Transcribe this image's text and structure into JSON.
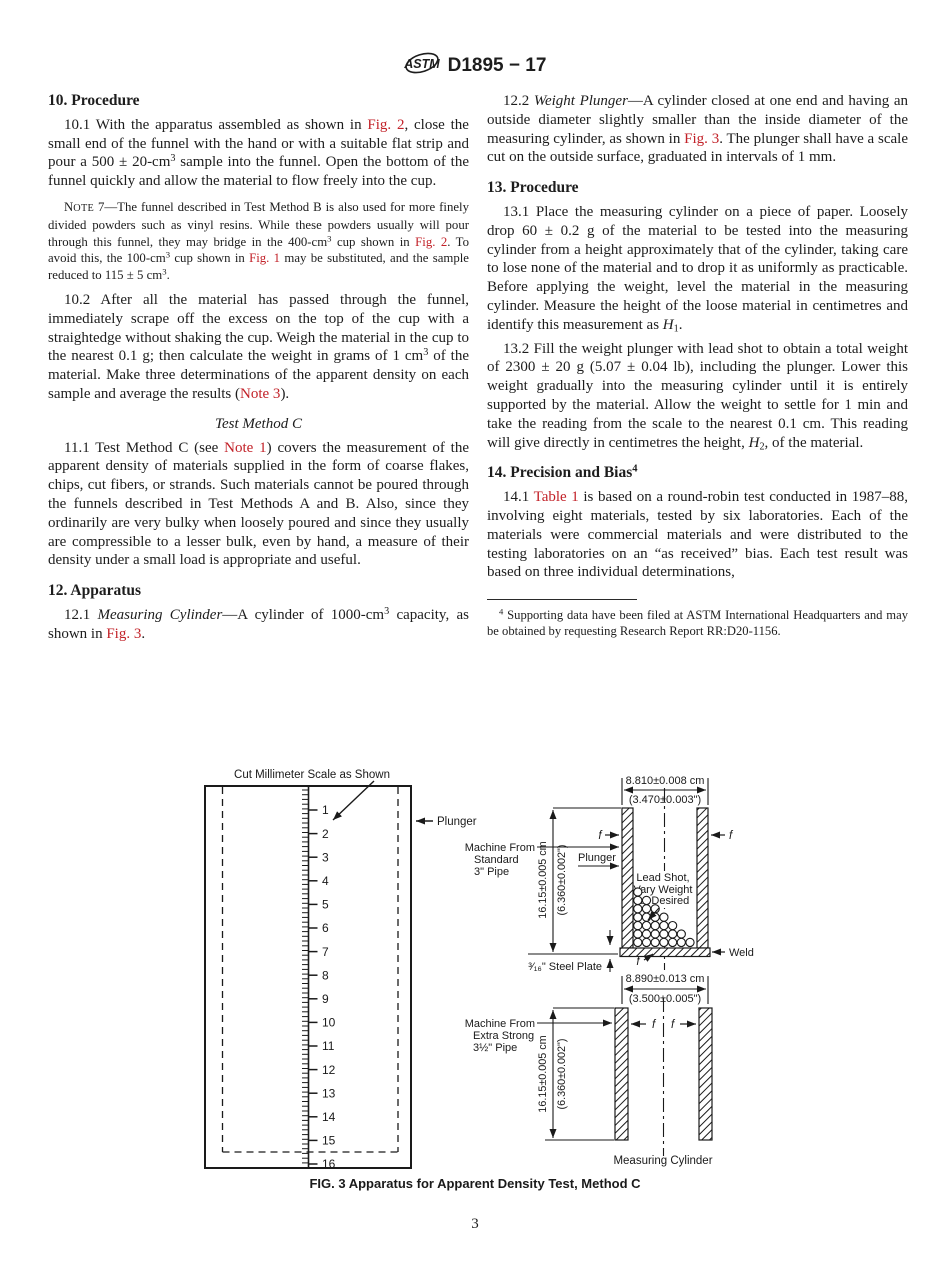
{
  "header": {
    "logo_text": "ASTM",
    "code": "D1895 − 17"
  },
  "page_number": "3",
  "left": {
    "h10": "10.  Procedure",
    "p10_1": [
      {
        "t": "10.1  With the apparatus assembled as shown in "
      },
      {
        "t": "Fig. 2",
        "c": "ref",
        "n": "ref-fig-2"
      },
      {
        "t": ", close the small end of the funnel with the hand or with a suitable flat strip and pour a 500 ± 20-cm"
      },
      {
        "t": "3",
        "c": "sup"
      },
      {
        "t": " sample into the funnel. Open the bottom of the funnel quickly and allow the material to flow freely into the cup."
      }
    ],
    "note7": [
      {
        "t": "N"
      },
      {
        "t": "OTE",
        "c": "sc"
      },
      {
        "t": " 7—The funnel described in Test Method B is also used for more finely divided powders such as vinyl resins. While these powders usually will pour through this funnel, they may bridge in the 400-cm"
      },
      {
        "t": "3",
        "c": "sup"
      },
      {
        "t": " cup shown in "
      },
      {
        "t": "Fig. 2",
        "c": "ref",
        "n": "ref-fig-2"
      },
      {
        "t": ". To avoid this, the 100-cm"
      },
      {
        "t": "3",
        "c": "sup"
      },
      {
        "t": " cup shown in "
      },
      {
        "t": "Fig. 1",
        "c": "ref",
        "n": "ref-fig-1"
      },
      {
        "t": " may be substituted, and the sample reduced to 115 ± 5 cm"
      },
      {
        "t": "3",
        "c": "sup"
      },
      {
        "t": "."
      }
    ],
    "p10_2": [
      {
        "t": "10.2  After all the material has passed through the funnel, immediately scrape off the excess on the top of the cup with a straightedge without shaking the cup. Weigh the material in the cup to the nearest 0.1 g; then calculate the weight in grams of 1 cm"
      },
      {
        "t": "3",
        "c": "sup"
      },
      {
        "t": " of the material. Make three determinations of the apparent density on each sample and average the results ("
      },
      {
        "t": "Note 3",
        "c": "ref",
        "n": "ref-note-3"
      },
      {
        "t": ")."
      }
    ],
    "h11": "Test Method C",
    "p11_1": [
      {
        "t": "11.1  Test Method C (see "
      },
      {
        "t": "Note 1",
        "c": "ref",
        "n": "ref-note-1"
      },
      {
        "t": ") covers the measurement of the apparent density of materials supplied in the form of coarse flakes, chips, cut fibers, or strands. Such materials cannot be poured through the funnels described in Test Methods A and B. Also, since they ordinarily are very bulky when loosely poured and since they usually are compressible to a lesser bulk, even by hand, a measure of their density under a small load is appropriate and useful."
      }
    ],
    "h12": "12.  Apparatus",
    "p12_1": [
      {
        "t": "12.1  "
      },
      {
        "t": "Measuring Cylinder",
        "c": "it"
      },
      {
        "t": "—A cylinder of 1000-cm"
      },
      {
        "t": "3",
        "c": "sup"
      },
      {
        "t": " capacity, as shown in "
      },
      {
        "t": "Fig. 3",
        "c": "ref",
        "n": "ref-fig-3"
      },
      {
        "t": "."
      }
    ]
  },
  "right": {
    "p12_2": [
      {
        "t": "12.2  "
      },
      {
        "t": "Weight Plunger",
        "c": "it"
      },
      {
        "t": "—A cylinder closed at one end and having an outside diameter slightly smaller than the inside diameter of the measuring cylinder, as shown in "
      },
      {
        "t": "Fig. 3",
        "c": "ref",
        "n": "ref-fig-3"
      },
      {
        "t": ". The plunger shall have a scale cut on the outside surface, graduated in intervals of 1 mm."
      }
    ],
    "h13": "13.  Procedure",
    "p13_1": [
      {
        "t": "13.1  Place the measuring cylinder on a piece of paper. Loosely drop 60 ± 0.2 g of the material to be tested into the measuring cylinder from a height approximately that of the cylinder, taking care to lose none of the material and to drop it as uniformly as practicable. Before applying the weight, level the material in the measuring cylinder. Measure the height of the loose material in centimetres and identify this measurement as "
      },
      {
        "t": "H",
        "c": "it"
      },
      {
        "t": "1",
        "c": "sub"
      },
      {
        "t": "."
      }
    ],
    "p13_2": [
      {
        "t": "13.2  Fill the weight plunger with lead shot to obtain a total weight of 2300 ± 20 g (5.07 ± 0.04 lb), including the plunger. Lower this weight gradually into the measuring cylinder until it is entirely supported by the material. Allow the weight to settle for 1 min and take the reading from the scale to the nearest 0.1 cm. This reading will give directly in centimetres the height, "
      },
      {
        "t": "H",
        "c": "it"
      },
      {
        "t": "2",
        "c": "sub"
      },
      {
        "t": ", of the material."
      }
    ],
    "h14": [
      {
        "t": "14.  Precision and Bias"
      },
      {
        "t": "4",
        "c": "sup"
      }
    ],
    "p14_1": [
      {
        "t": "14.1  "
      },
      {
        "t": "Table 1",
        "c": "ref",
        "n": "ref-table-1"
      },
      {
        "t": " is based on a round-robin test conducted in 1987–88, involving eight materials, tested by six laboratories. Each of the materials were commercial materials and were distributed to the testing laboratories on an “as received” bias. Each test result was based on three individual determinations,"
      }
    ],
    "footnote4": [
      {
        "t": "4",
        "c": "sup"
      },
      {
        "t": " Supporting data have been filed at ASTM International Headquarters and may be obtained by requesting Research Report RR:D20-1156."
      }
    ]
  },
  "figure": {
    "caption": "FIG. 3  Apparatus for Apparent Density Test, Method C",
    "scale_label": "Cut Millimeter Scale as Shown",
    "plunger_pointer_label": "Plunger",
    "scale_numbers": [
      1,
      2,
      3,
      4,
      5,
      6,
      7,
      8,
      9,
      10,
      11,
      12,
      13,
      14,
      15,
      16
    ],
    "top_dim_cm": "8.810±0.008 cm",
    "top_dim_in": "(3.470±0.003\")",
    "machine_standard": [
      "Machine From",
      "Standard",
      "3\" Pipe"
    ],
    "plunger_label": "Plunger",
    "height_dim_cm": "16.15±0.005 cm",
    "height_dim_in": "(6.360±0.002\")",
    "lead_shot": [
      "Lead Shot,",
      "Vary Weight",
      "as Desired"
    ],
    "weld_label": "Weld",
    "steel_plate_label": "³⁄₁₆\" Steel Plate",
    "f_label": "f",
    "bottom_dim_cm": "8.890±0.013 cm",
    "bottom_dim_in": "(3.500±0.005\")",
    "machine_extra": [
      "Machine From",
      "Extra Strong",
      "3½\" Pipe"
    ],
    "measuring_cylinder_label": "Measuring Cylinder"
  }
}
